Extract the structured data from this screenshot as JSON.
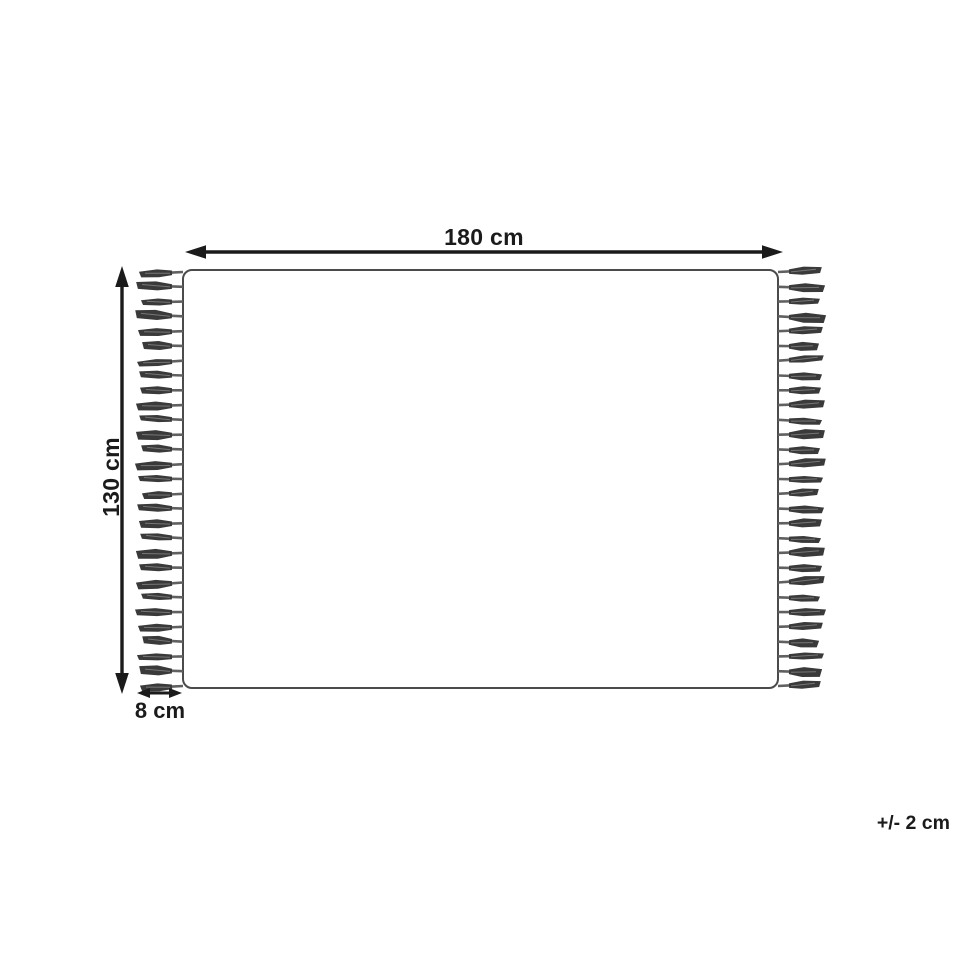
{
  "diagram": {
    "title": "rug-dimension-diagram",
    "width_label": "180 cm",
    "height_label": "130 cm",
    "fringe_label": "8 cm",
    "tolerance_label": "+/- 2 cm",
    "tassels_per_side": 29,
    "colors": {
      "background": "#ffffff",
      "outline": "#4b4b4b",
      "arrow": "#1b1b1b",
      "text": "#1b1b1b",
      "tassel_body": "#3a3a3a",
      "tassel_streak": "#8a8a8a",
      "tassel_stem": "#606060"
    }
  }
}
